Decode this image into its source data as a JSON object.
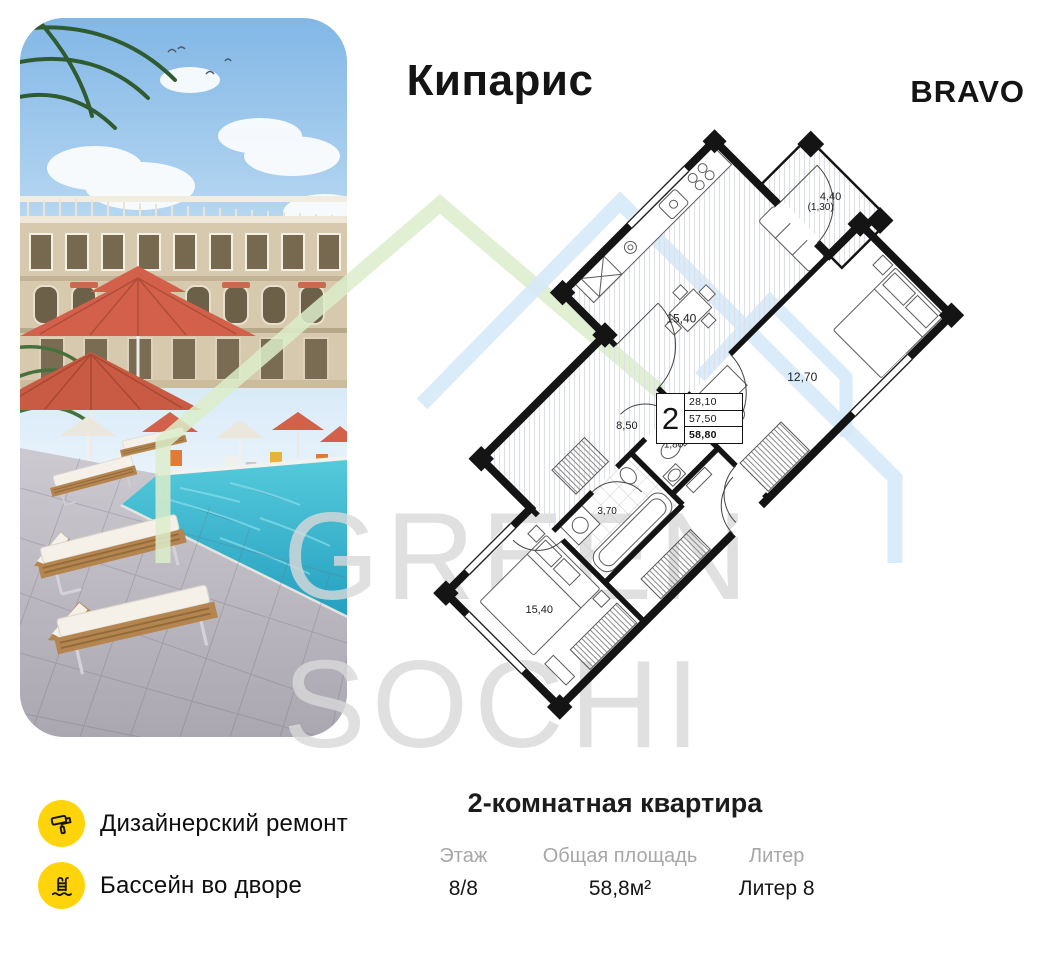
{
  "header": {
    "title": "Кипарис",
    "brand": "BRAVO"
  },
  "watermark": {
    "line1": "GREEN",
    "line2": "SOCHI",
    "green": "#dcedca",
    "blue": "#d6e9f8",
    "text_color": "#d9d9d9"
  },
  "floor_plan": {
    "balcony_area": "4,40",
    "balcony_reduced": "(1,30)",
    "rooms": [
      {
        "name": "kitchen-living",
        "label": "15,40"
      },
      {
        "name": "bedroom",
        "label": "12,70"
      },
      {
        "name": "hallway",
        "label": "8,50"
      },
      {
        "name": "wc",
        "label": "1,80"
      },
      {
        "name": "bathroom",
        "label": "3,70"
      },
      {
        "name": "bedroom-2",
        "label": "15,40"
      }
    ],
    "summary": {
      "rooms_count": "2",
      "living_area": "28,10",
      "area_mid": "57,50",
      "total_area": "58,80"
    }
  },
  "features": [
    {
      "icon": "paint-roller-icon",
      "label": "Дизайнерский ремонт"
    },
    {
      "icon": "pool-ladder-icon",
      "label": "Бассейн во дворе"
    }
  ],
  "apartment": {
    "title": "2-комнатная квартира",
    "stats": [
      {
        "label": "Этаж",
        "value": "8/8"
      },
      {
        "label": "Общая площадь",
        "value": "58,8м²"
      },
      {
        "label": "Литер",
        "value": "Литер 8"
      }
    ]
  },
  "colors": {
    "accent_yellow": "#ffd40a",
    "umbrella": "#d2604a",
    "pool": "#3fbcd0",
    "wall": "#141414"
  }
}
